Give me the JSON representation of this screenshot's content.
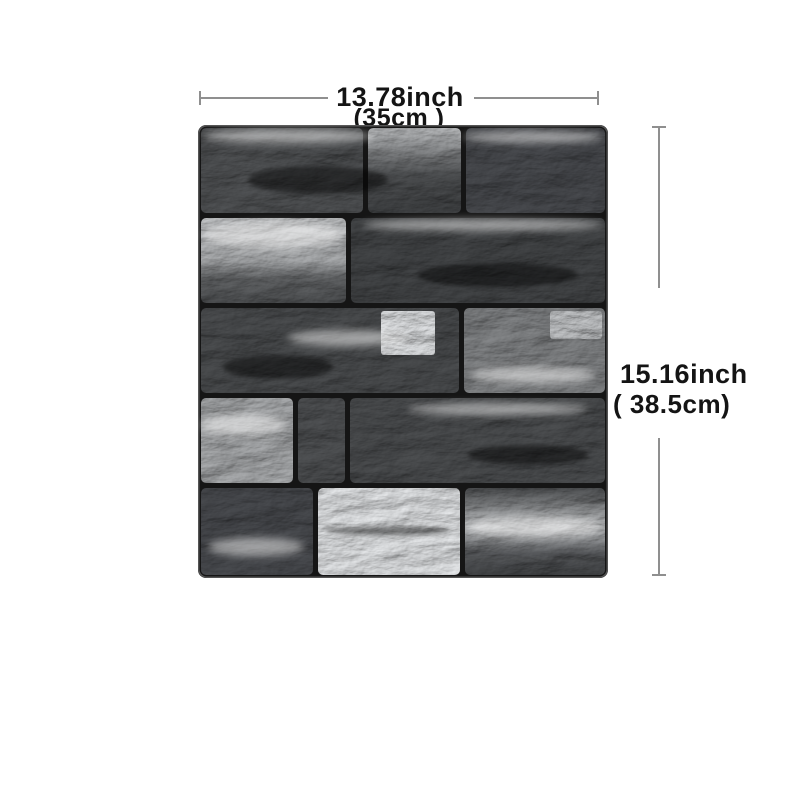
{
  "diagram": {
    "width_dimension": {
      "inches_label": "13.78inch",
      "metric_label": "(35cm )"
    },
    "height_dimension": {
      "inches_label": "15.16inch",
      "metric_label": "( 38.5cm)"
    },
    "colors": {
      "background": "#ffffff",
      "dimension_line": "#8f8f8f",
      "dimension_text": "#141414",
      "panel_grout": "#151515",
      "brick_dark": "#46484a",
      "brick_mid": "#8a8c8e",
      "brick_light": "#d6d8da"
    }
  }
}
